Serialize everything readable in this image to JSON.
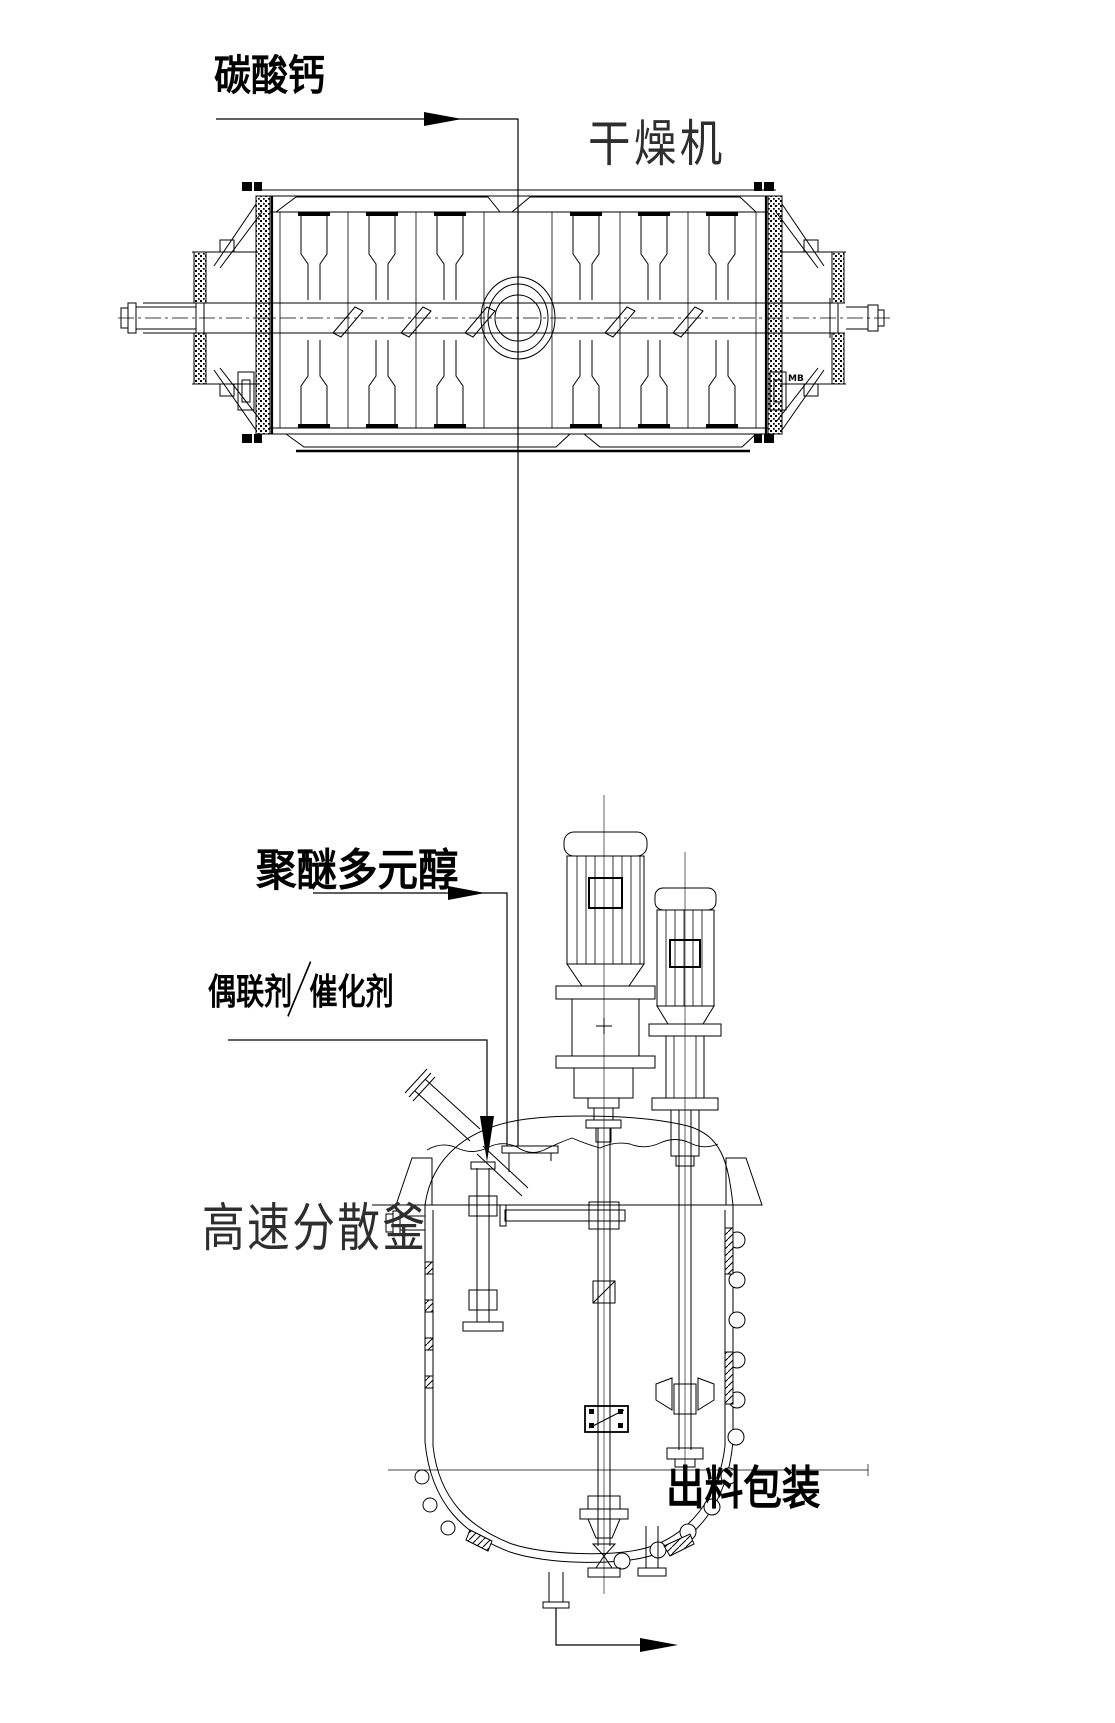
{
  "page": {
    "background": "#ffffff",
    "ink": "#000000"
  },
  "labels": {
    "calcium_carbonate": "碳酸钙",
    "dryer": "干燥机",
    "polyether_polyol": "聚醚多元醇",
    "coupling_agent": "偶联剂",
    "catalyst": "催化剂",
    "high_speed_dispersion_kettle": "高速分散釜",
    "discharge_packaging": "出料包装",
    "bearing_note": "MB"
  }
}
